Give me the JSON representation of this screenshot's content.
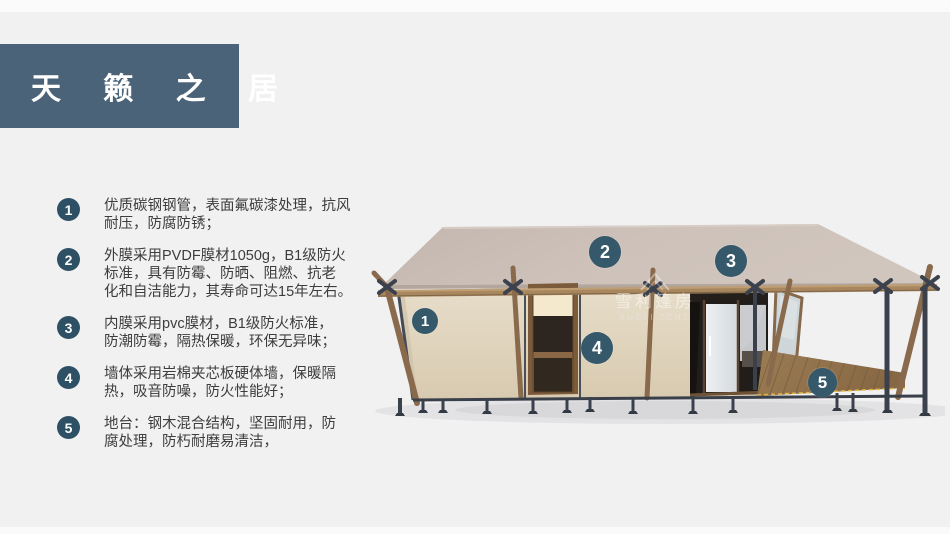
{
  "page": {
    "title": "天 籁 之 居"
  },
  "features": [
    {
      "num": "1",
      "text": "优质碳钢钢管，表面氟碳漆处理，抗风\n耐压，防腐防锈；"
    },
    {
      "num": "2",
      "text": "外膜采用PVDF膜材1050g，B1级防火\n标准，具有防霉、防晒、阻燃、抗老\n化和自洁能力，其寿命可达15年左右。"
    },
    {
      "num": "3",
      "text": "内膜采用pvc膜材，B1级防火标准，\n防潮防霉，隔热保暖，环保无异味；"
    },
    {
      "num": "4",
      "text": "墙体采用岩棉夹芯板硬体墙，保暖隔\n热，吸音防噪，防火性能好；"
    },
    {
      "num": "5",
      "text": "地台：钢木混合结构，坚固耐用，防\n腐处理，防朽耐磨易清洁，"
    }
  ],
  "markers": [
    {
      "label": "1"
    },
    {
      "label": "2"
    },
    {
      "label": "3"
    },
    {
      "label": "4"
    },
    {
      "label": "5"
    }
  ],
  "watermark": {
    "cn": "雪利篷房",
    "en": "XUELI TENT"
  },
  "colors": {
    "background": "#f1f1f2",
    "title_box": "#4b6378",
    "badge": "#2e5064",
    "marker": "#35596b",
    "text": "#3d3d3d",
    "roof": "#cbbfb7",
    "wall": "#e0d5bf",
    "wood": "#8a6a4c",
    "metal": "#3a414c",
    "deck": "#97774f"
  }
}
